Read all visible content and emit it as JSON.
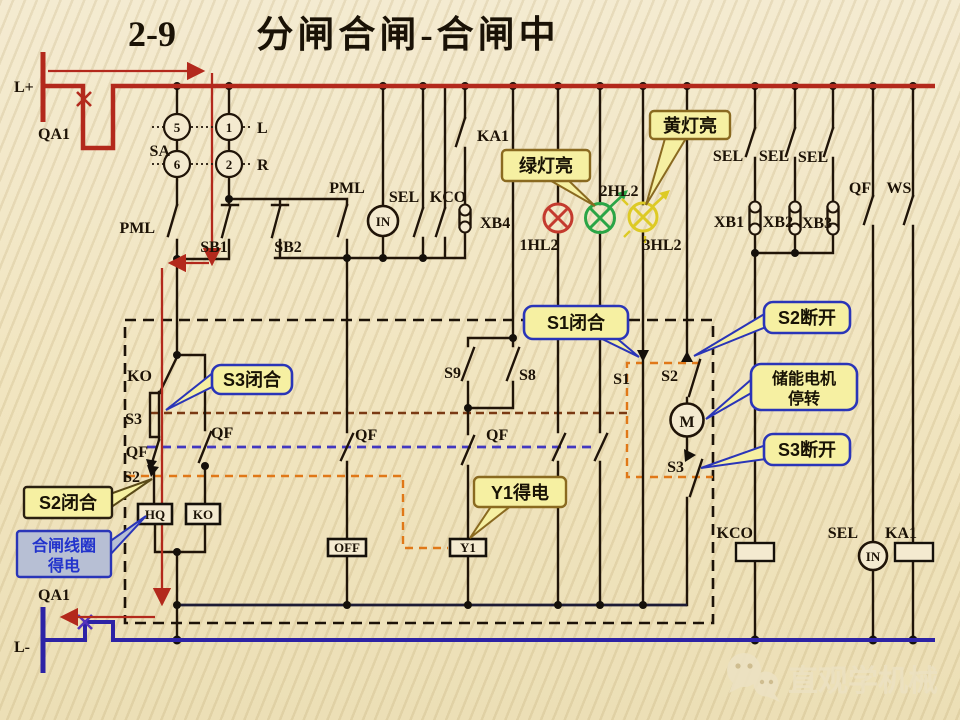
{
  "title": {
    "number": "2-9",
    "text": "分闸合闸-合闸中"
  },
  "terminals": {
    "l_plus": "L+",
    "l_minus": "L-",
    "qa1_top": "QA1",
    "qa1_bottom": "QA1"
  },
  "selector_sa": {
    "label": "SA",
    "contact_5": "5",
    "contact_6": "6",
    "contact_1": "1",
    "contact_2": "2",
    "pos_left": "L",
    "pos_right": "R"
  },
  "control_row": {
    "pml_left": "PML",
    "sb1": "SB1",
    "sb2": "SB2",
    "pml_right": "PML",
    "in_meter": "IN",
    "sel": "SEL",
    "kco": "KCO",
    "ka1": "KA1",
    "xb4": "XB4"
  },
  "lamps": {
    "lamp1": "1HL2",
    "lamp2": "2HL2",
    "lamp3": "3HL2"
  },
  "right_columns": {
    "sel1": "SEL",
    "sel2": "SEL",
    "sel3": "SEL",
    "xb1": "XB1",
    "xb2": "XB2",
    "xb3": "XB3",
    "qf": "QF",
    "ws": "WS"
  },
  "interlock_box": {
    "ko_contact": "KO",
    "s3_contact": "S3",
    "qf_contact_left": "QF",
    "s2_contact": "S2",
    "qf_contact_mid": "QF",
    "hq_coil": "HQ",
    "ko_coil": "KO",
    "off_coil": "OFF",
    "s9_contact": "S9",
    "s8_contact": "S8",
    "qf_contact_s9": "QF",
    "qf_contact_off": "QF",
    "y1_coil": "Y1",
    "s1_contact": "S1",
    "s2_contact_right": "S2",
    "motor": "M",
    "s3_contact_right": "S3"
  },
  "bottom_right": {
    "kco_label": "KCO",
    "sel_label": "SEL",
    "in_meter": "IN",
    "ka1_label": "KA1"
  },
  "callouts": {
    "green_lamp": "绿灯亮",
    "yellow_lamp": "黄灯亮",
    "s1_closed": "S1闭合",
    "s2_open": "S2断开",
    "motor_stop_line1": "储能电机",
    "motor_stop_line2": "停转",
    "s3_open": "S3断开",
    "s3_closed": "S3闭合",
    "s2_closed": "S2闭合",
    "closing_coil_line1": "合闸线圈",
    "closing_coil_line2": "得电",
    "y1_energized": "Y1得电"
  },
  "watermark": {
    "brand": "直观学机械"
  },
  "colors": {
    "bus_positive": "#b3291c",
    "bus_negative": "#2d23a6",
    "wire": "#201408",
    "callout_fill": "#f6f0a2",
    "callout_border_blue": "#2a35b8",
    "callout_border_olive": "#8a6a20",
    "note_box_fill": "#b7bfd4",
    "note_text": "#2233cc",
    "lamp_red": "#c43b2e",
    "lamp_green": "#2ba546",
    "lamp_yellow": "#ddca25",
    "link_brown": "#7a3a14",
    "link_blue": "#4338c0",
    "link_orange": "#e07818",
    "background": "#f1e6c3"
  }
}
